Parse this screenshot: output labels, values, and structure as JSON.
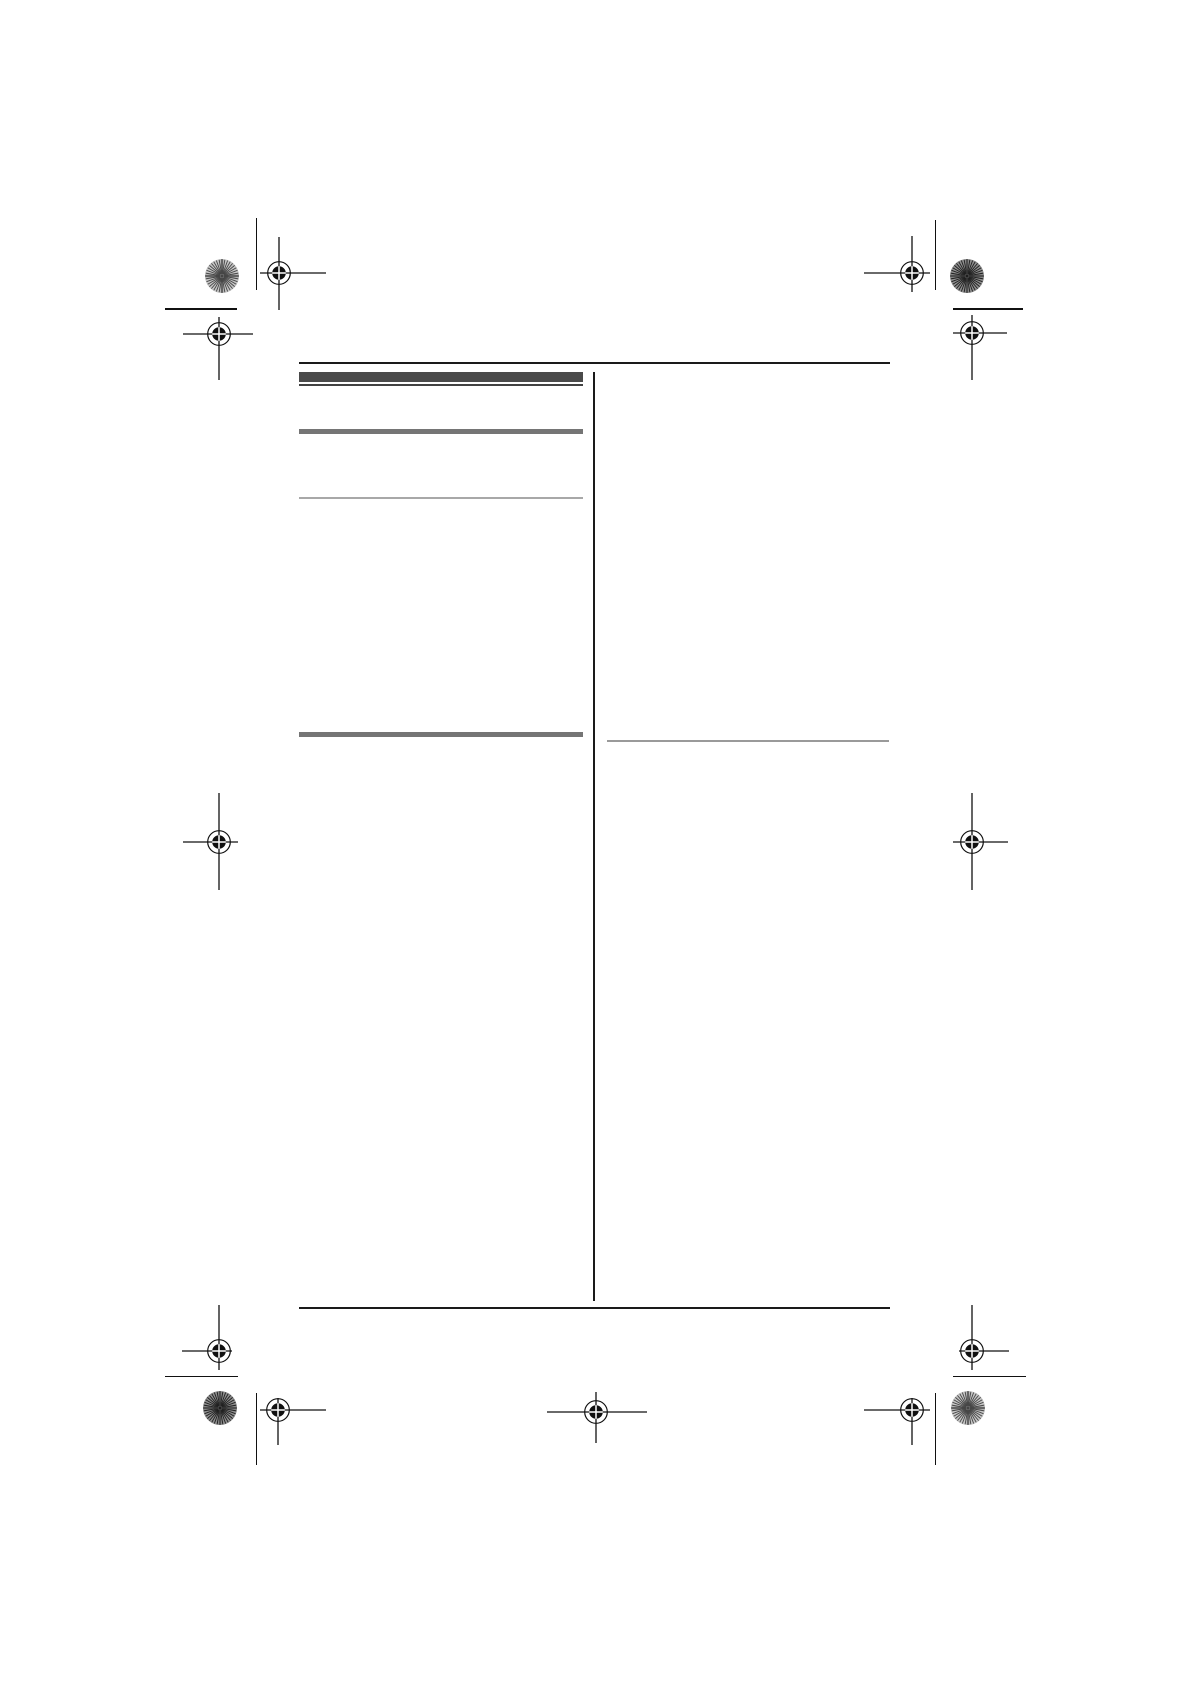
{
  "page": {
    "width": 1190,
    "height": 1684,
    "background": "#ffffff"
  },
  "palette": {
    "rule_black": "#1a1a1a",
    "mark_black": "#111111",
    "bar_dark": "#4a4a4a",
    "bar_dark_underline": "#424242",
    "bar_gray": "#757575",
    "rule_light_left": "#a8a8a8",
    "rule_light_right": "#9a9a9a",
    "pinwheel_light_base": "#c6c6c6",
    "pinwheel_light_line": "#454545",
    "pinwheel_dark_base": "#8e8e8e",
    "pinwheel_dark_line": "#1e1e1e"
  },
  "frame": {
    "top_rule": {
      "x": 299,
      "y": 361.5,
      "w": 591,
      "h": 2.3
    },
    "bottom_rule": {
      "x": 299,
      "y": 1306.5,
      "w": 591,
      "h": 2.3
    },
    "column_divider": {
      "x": 593.2,
      "y": 371.5,
      "w": 1.8,
      "h": 929.5
    }
  },
  "left_column_bars": [
    {
      "name": "section-header-bar-dark",
      "x": 299,
      "y": 372,
      "w": 284,
      "h": 10,
      "color_key": "bar_dark"
    },
    {
      "name": "section-header-underline",
      "x": 299,
      "y": 384.4,
      "w": 284,
      "h": 1.6,
      "color_key": "bar_dark_underline"
    },
    {
      "name": "subsection-bar-gray",
      "x": 299,
      "y": 429,
      "w": 284,
      "h": 4.6,
      "color_key": "bar_gray"
    },
    {
      "name": "light-rule-left",
      "x": 299,
      "y": 496.6,
      "w": 284,
      "h": 2,
      "color_key": "rule_light_left"
    },
    {
      "name": "subsection-bar-gray",
      "x": 299,
      "y": 732,
      "w": 284,
      "h": 4.6,
      "color_key": "bar_gray"
    }
  ],
  "right_column_rules": [
    {
      "name": "light-rule-right",
      "x": 607,
      "y": 740,
      "w": 282,
      "h": 2,
      "color_key": "rule_light_right"
    }
  ],
  "mark_geometry": {
    "outer_radius": 11.3,
    "disk_radius": 6.8,
    "stroke": 1.3,
    "cross_white": 1.5
  },
  "registration_marks": [
    {
      "name": "reg-mark-top-left-inner",
      "cx": 279,
      "cy": 273,
      "arm_left": 19,
      "arm_right": 47,
      "arm_up": 36,
      "arm_down": 37
    },
    {
      "name": "reg-mark-top-left-outer",
      "cx": 219,
      "cy": 334,
      "arm_left": 36,
      "arm_right": 34,
      "arm_up": 17,
      "arm_down": 46
    },
    {
      "name": "reg-mark-top-right-inner",
      "cx": 912,
      "cy": 273,
      "arm_left": 48,
      "arm_right": 18,
      "arm_up": 37,
      "arm_down": 19
    },
    {
      "name": "reg-mark-top-right-outer",
      "cx": 972,
      "cy": 333,
      "arm_left": 19,
      "arm_right": 35,
      "arm_up": 18,
      "arm_down": 47
    },
    {
      "name": "reg-mark-middle-left",
      "cx": 219,
      "cy": 842,
      "arm_left": 36,
      "arm_right": 19,
      "arm_up": 49,
      "arm_down": 48
    },
    {
      "name": "reg-mark-middle-right",
      "cx": 972,
      "cy": 842,
      "arm_left": 19,
      "arm_right": 36,
      "arm_up": 49,
      "arm_down": 48
    },
    {
      "name": "reg-mark-bottom-left-outer",
      "cx": 219,
      "cy": 1351,
      "arm_left": 37,
      "arm_right": 13,
      "arm_up": 46,
      "arm_down": 19
    },
    {
      "name": "reg-mark-bottom-left-inner",
      "cx": 278,
      "cy": 1410,
      "arm_left": 18,
      "arm_right": 48,
      "arm_up": 12,
      "arm_down": 35
    },
    {
      "name": "reg-mark-bottom-center",
      "cx": 596,
      "cy": 1412,
      "arm_left": 49,
      "arm_right": 51,
      "arm_up": 20,
      "arm_down": 31
    },
    {
      "name": "reg-mark-bottom-right-inner",
      "cx": 912,
      "cy": 1410,
      "arm_left": 48,
      "arm_right": 18,
      "arm_up": 12,
      "arm_down": 35
    },
    {
      "name": "reg-mark-bottom-right-outer",
      "cx": 972,
      "cy": 1351,
      "arm_left": 13,
      "arm_right": 37,
      "arm_up": 46,
      "arm_down": 19
    }
  ],
  "pinwheel_targets": [
    {
      "name": "pinwheel-target-top-left",
      "cx": 222,
      "cy": 276,
      "r": 17,
      "shade": "light"
    },
    {
      "name": "pinwheel-target-top-right",
      "cx": 967,
      "cy": 276,
      "r": 17,
      "shade": "dark"
    },
    {
      "name": "pinwheel-target-bottom-left",
      "cx": 220,
      "cy": 1408,
      "r": 17,
      "shade": "dark"
    },
    {
      "name": "pinwheel-target-bottom-right",
      "cx": 968,
      "cy": 1408,
      "r": 17,
      "shade": "light"
    }
  ],
  "trim_marks": [
    {
      "name": "trim-mark-top-left-v",
      "orient": "v",
      "x": 255.7,
      "y": 218,
      "len": 72
    },
    {
      "name": "trim-mark-top-left-h",
      "orient": "h",
      "x": 165,
      "y": 308.3,
      "len": 72
    },
    {
      "name": "trim-mark-top-right-v",
      "orient": "v",
      "x": 935,
      "y": 220,
      "len": 70
    },
    {
      "name": "trim-mark-top-right-h",
      "orient": "h",
      "x": 953,
      "y": 308.3,
      "len": 70
    },
    {
      "name": "trim-mark-bottom-left-h",
      "orient": "h",
      "x": 165,
      "y": 1375.7,
      "len": 73
    },
    {
      "name": "trim-mark-bottom-left-v",
      "orient": "v",
      "x": 255.7,
      "y": 1393,
      "len": 72
    },
    {
      "name": "trim-mark-bottom-right-h",
      "orient": "h",
      "x": 953,
      "y": 1375.7,
      "len": 73
    },
    {
      "name": "trim-mark-bottom-right-v",
      "orient": "v",
      "x": 935,
      "y": 1393,
      "len": 72
    }
  ]
}
